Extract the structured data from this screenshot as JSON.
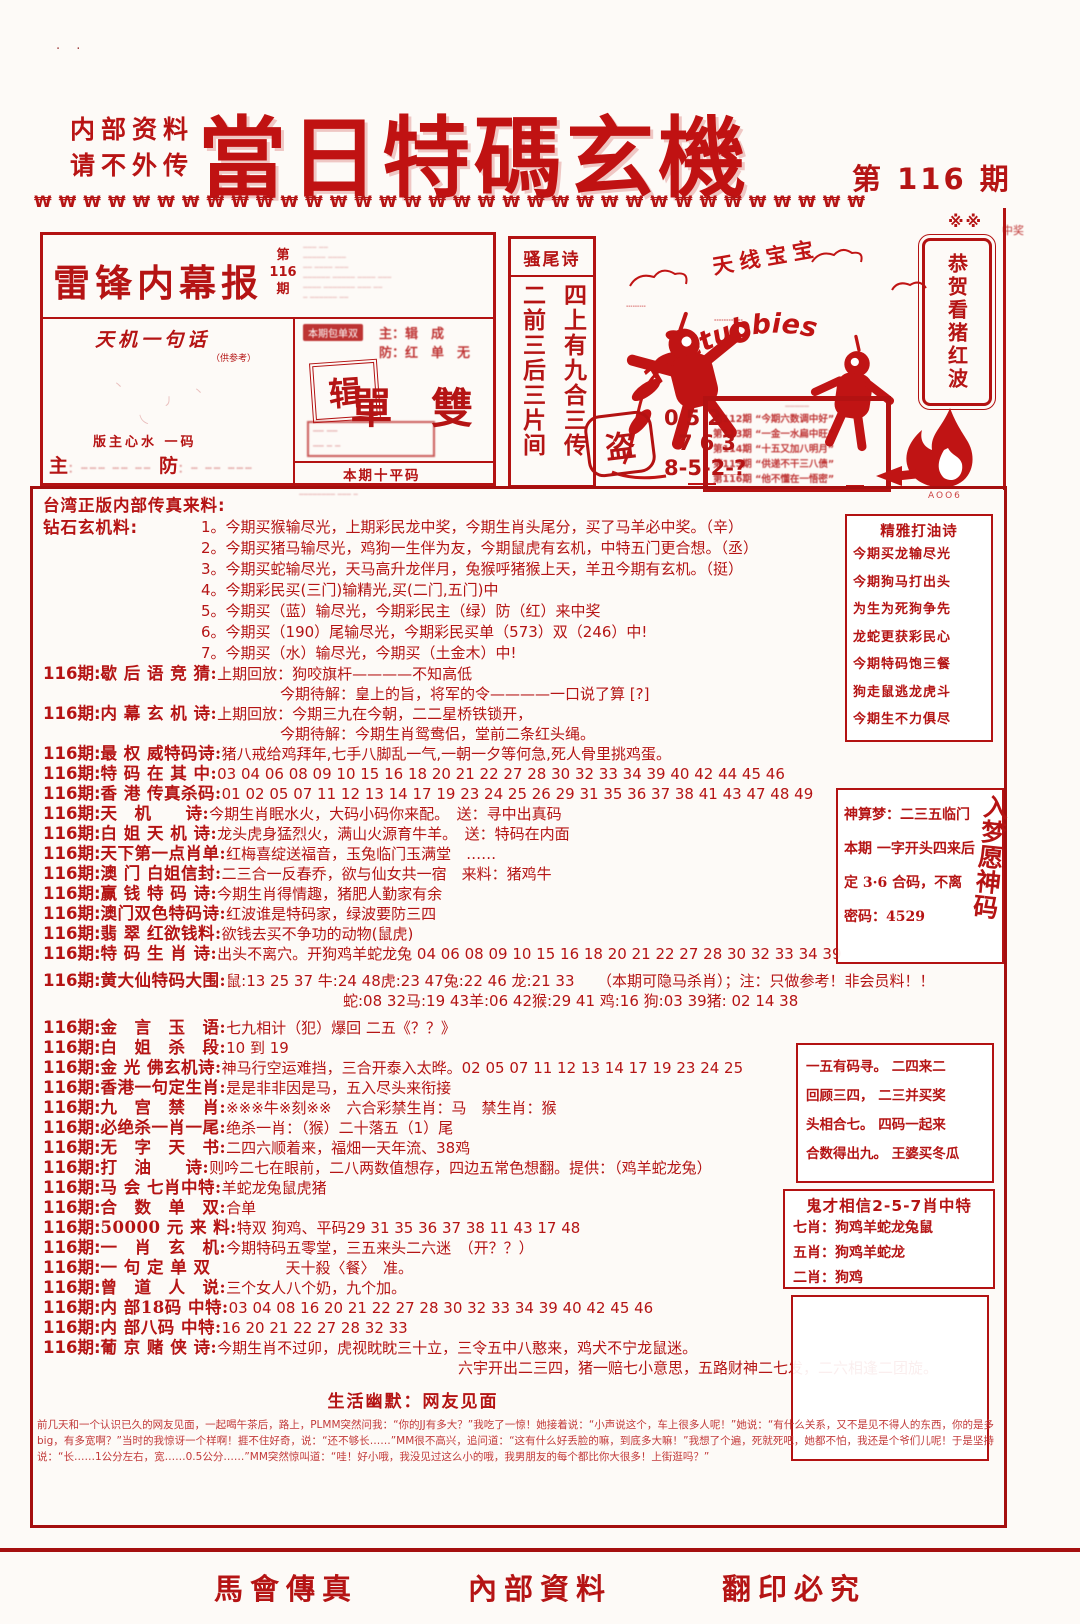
{
  "palette": {
    "red": "#b51414",
    "dark_red": "#a50f0f",
    "bright_red": "#c01212"
  },
  "header": {
    "corner_marks": "· ·",
    "note1": "内部资料",
    "note2": "请不外传",
    "title": "當日特碼玄機",
    "issue": "第 116 期",
    "decor": "₩₩₩₩₩₩₩₩₩₩₩₩₩₩₩₩₩₩₩₩₩₩₩₩₩₩₩₩₩₩₩₩₩₩",
    "decor2": "※※"
  },
  "masthead": {
    "title": "雷锋内幕报",
    "issue_top": "第",
    "issue_mid": "116",
    "issue_bot": "期",
    "small_print": [
      "┄┄┄ ┄┄",
      "┄┄┄┄┄ ┄┄┄┄",
      "┄┄ ┄┄┄┄ ┄┄┄",
      "┄┄┄┄┄┄ ┄┄┄┄┄ ┄┄┄┄ ┄┄┄",
      "┄┄┄┄ ┄┄┄┄┄┄┄ ┄┄┄ ┄┄",
      "┄ ┄┄┄┄┄┄ ┄┄"
    ],
    "tianji_title": "天机一句话",
    "tianji_sub": "（供参考）",
    "tianji_marks": [
      "丶",
      "丿",
      "乀",
      "丶"
    ],
    "banzhu": "版主心水 一码",
    "zhu_label": "主",
    "zhu_blur": "：┄┄┄ ┄┄ ┄┄",
    "fang_label": "防",
    "fang_blur": "：┄ ┄┄ ┄┄┄",
    "right_tag": "本期包单双",
    "zf1": "主：辑　成",
    "zf2": "防：红　单　无",
    "stamp": "辑",
    "dan_shuang": "單 雙",
    "small_box1": "┄┄ ┄┄",
    "small_box2": "┄┄ ┄ ┄",
    "pingma_title": "本期十平码",
    "pingma_l1": "┄┄┄┄ ┄┄┄ ┄┄┄┄┄┄ ┄┄┄┄┄ ┄┄ ┄┄┄┄┄┄┄┄┄",
    "pingma_l2": "┄┄┄┄┄┄┄┄ ┄┄┄ ┄"
  },
  "saoweishi": {
    "title": "骚尾诗",
    "col_right": "四上有九合三传",
    "col_left": "二前三后三片间"
  },
  "tele": {
    "label": "天线宝宝",
    "arc": "Teletubbies",
    "stamp1": "┄┄┄",
    "stamp2": "┄┄┄┄",
    "caption": "┄┄┄┄┄┄"
  },
  "dao_stamp": {
    "char": "盗",
    "n1": "052",
    "n2": "763",
    "n3": "8-5-2-?"
  },
  "recap": {
    "header": "┄┄┄┄┄",
    "lines": [
      "第112期 “今期六数调中好”",
      "第113期 “一金一水扁中旺”",
      "第114期 “十五又加八明月”",
      "第115期 “供递不干三八债”",
      "第116期 “他不懂在一悟密”"
    ]
  },
  "banner": {
    "text": "恭贺看猪红波",
    "note": "中奖"
  },
  "flame": {
    "caption": "AOO6"
  },
  "main": {
    "intro_title": "台湾正版内部传真来料:",
    "intro_label": "钻石玄机料:",
    "intro_items": [
      "1。今期买猴输尽光，上期彩民龙中奖，今期生肖头尾分，买了马羊必中奖。（辛）",
      "2。今期买猪马输尽光，鸡狗一生伴为友，今期鼠虎有玄机，中特五门更合想。（丞）",
      "3。今期买蛇输尽光，天马高升龙伴月，兔猴呼猪猴上天，羊丑今期有玄机。（挺）",
      "4。今期彩民买(三门)输精光,买(二门,五门)中",
      "5。今期买（蓝）输尽光，今期彩民主（绿）防（红）来中奖",
      "6。今期买（190）尾输尽光，今期彩民买单（573）双（246）中!",
      "7。今期买（水）输尽光，今期买（土金木）中!"
    ],
    "rows": [
      {
        "no": "116期:",
        "label": "歇 后 语 竞 猜:",
        "c1": "上期回放：狗咬旗杆————不知高低",
        "c2": "今期待解：皇上的旨，将军的令————一口说了算 [?]"
      },
      {
        "no": "116期:",
        "label": "内 幕 玄 机 诗:",
        "c1": "上期回放：今期三九在今朝，二二星桥铁锁开，",
        "c2": "今期待解：今期生肖鸳鸯侣，堂前二条红头绳。"
      },
      {
        "no": "116期:",
        "label": "最 权 威特码诗:",
        "c1": "猪八戒给鸡拜年,七手八脚乱一气,一朝一夕等何急,死人骨里挑鸡蛋。"
      },
      {
        "no": "116期:",
        "label": "特 码 在 其 中:",
        "c1": "03 04 06 08 09 10 15 16 18 20 21 22 27 28 30 32 33 34 39 40 42 44 45 46"
      },
      {
        "no": "116期:",
        "label": "香 港 传真杀码:",
        "c1": "01 02 05 07 11 12 13 14 17 19 23 24 25 26 29 31 35 36 37 38 41 43 47 48 49"
      },
      {
        "no": "116期:",
        "label": "天　机　　诗:",
        "c1": "今期生肖眠水火，大码小码你来配。　送：寻中出真码"
      },
      {
        "no": "116期:",
        "label": "白 姐 天 机 诗:",
        "c1": "龙头虎身猛烈火，满山火源育牛羊。　送：特码在内面"
      },
      {
        "no": "116期:",
        "label": "天下第一点肖单:",
        "c1": "红梅喜绽送福音，玉兔临门玉满堂　……"
      },
      {
        "no": "116期:",
        "label": "澳 门 白姐信封:",
        "c1": "二三合一反春乔，欲与仙女共一宿　来料：猪鸡牛"
      },
      {
        "no": "116期:",
        "label": "赢 钱 特 码 诗:",
        "c1": "今期生肖得情趣，猪肥人勤家有余"
      },
      {
        "no": "116期:",
        "label": "澳门双色特码诗:",
        "c1": "红波谁是特码家，绿波要防三四"
      },
      {
        "no": "116期:",
        "label": "翡 翠 红欲钱料:",
        "c1": "欲钱去买不争功的动物(鼠虎)"
      },
      {
        "no": "116期:",
        "label": "特 码 生 肖 诗:",
        "c1": "出头不离穴。开狗鸡羊蛇龙兔 04 06 08 09 10 15 16 18 20 21 22 27 28 30 32 33 34 39"
      },
      {
        "no": "116期:",
        "label": "黄大仙特码大围:",
        "c1": "鼠:13 25 37 牛:24 48虎:23 47兔:22 46 龙:21 33　　（本期可隐马杀肖）；注：只做参考！非会员料！！",
        "c2": "蛇:08 32马:19 43羊:06 42猴:29 41 鸡:16 狗:03 39猪: 02 14 38"
      },
      {
        "no": "116期:",
        "label": "金　言　玉　语:",
        "c1": "七九相计（犯）爆回 二五《？？》"
      },
      {
        "no": "116期:",
        "label": "白　姐　杀　段:",
        "c1": "10 到 19"
      },
      {
        "no": "116期:",
        "label": "金 光 佛玄机诗:",
        "c1": "神马行空运难挡，三合开泰入太晔。02 05 07 11 12 13 14 17 19 23 24 25"
      },
      {
        "no": "116期:",
        "label": "香港一句定生肖:",
        "c1": "是是非非因是马，五入尽头来衔接"
      },
      {
        "no": "116期:",
        "label": "九　宫　禁　肖:",
        "c1": "※※※牛※刻※※　六合彩禁生肖：马　禁生肖：猴"
      },
      {
        "no": "116期:",
        "label": "必绝杀一肖一尾:",
        "c1": "绝杀一肖：（猴）二十落五（1）尾"
      },
      {
        "no": "116期:",
        "label": "无　字　天　书:",
        "c1": "二四六顺着来，福畑一天年流、38鸡"
      },
      {
        "no": "116期:",
        "label": "打　油　　诗:",
        "c1": "则吟二七在眼前，二八两数值想存，四边五常色想翻。提供：（鸡羊蛇龙兔）"
      },
      {
        "no": "116期:",
        "label": "马 会 七肖中特:",
        "c1": "羊蛇龙兔鼠虎猪"
      },
      {
        "no": "116期:",
        "label": "合　数　单　双:",
        "c1": "合单"
      },
      {
        "no": "116期:",
        "label": "50000 元 来 料:",
        "c1": "特双 狗鸡、平码29 31 35 36 37 38 11 43 17 48"
      },
      {
        "no": "116期:",
        "label": "一　肖　玄　机:",
        "c1": "今期特码五零堂，三五来头二六迷　（开？？）"
      },
      {
        "no": "116期:",
        "label": "一 句 定 单 双",
        "c1": "　　　　　天十殺〈餐〉　准。"
      },
      {
        "no": "116期:",
        "label": "曾　道　人　说:",
        "c1": "三个女人八个奶，九个加。"
      },
      {
        "no": "116期:",
        "label": "内 部18码 中特:",
        "c1": "03 04 08 16 20 21 22 27 28 30 32 33 34 39 40 42 45 46"
      },
      {
        "no": "116期:",
        "label": "内 部八码 中特:",
        "c1": "16 20 21 22 27 28 32 33"
      },
      {
        "no": "116期:",
        "label": "葡 京 赌 侠 诗:",
        "c1": "今期生肖不过卯，虎视眈眈三十立，三令五中八憨来，鸡犬不宁龙鼠迷。",
        "c2": "六宇开出二三四，猪一赔七小意思，五路财神二七发，二六相逢二团旋。"
      }
    ],
    "humor_title": "生活幽默：网友见面",
    "humor_text": "前几天和一个认识已久的网友见面，一起喝午茶后，路上，PLMM突然问我：“你的JJ有多大？”我吃了一惊！她接着说：“小声说这个，车上很多人呢！”她说：“有什么关系，又不是见不得人的东西，你的是多big，有多宽啊？”当时的我惊讶一个样啊！捱不住好奇，说：“还不够长……”MM很不高兴，追问道：“这有什么好丢脸的嘛，到底多大嘛！”我想了个遍，死就死吧，她都不怕，我还是个爷们儿呢！于是坚持说：“长……1公分左右，宽……0.5公分……”MM突然惊叫道：“哇！好小哦，我没见过这么小的哦，我男朋友的每个都比你大很多！上街逛吗？”",
    "boxes": {
      "dayou": {
        "title": "精雅打油诗",
        "lines": [
          "今期买龙输尽光",
          "今期狗马打出头",
          "为生为死狗争先",
          "龙蛇更获彩民心",
          "今期特码饱三餐",
          "狗走鼠逃龙虎斗",
          "今期生不力俱尽"
        ]
      },
      "shensuan": {
        "l1": "神算梦：二三五临门",
        "l2": "本期 一字开头四来后",
        "l3": "定 3·6 合码，不离",
        "l4": "密码：4529",
        "vert": "入梦愿神码"
      },
      "mystery": {
        "lines": [
          "一五有码寻。 二四来二",
          "回顾三四， 二三并买奖",
          "头相合七。 四码一起来",
          "合数得出九。 王婆买冬瓜"
        ]
      },
      "guicai": {
        "title": "鬼才相信2-5-7肖中特",
        "lines": [
          "七肖：狗鸡羊蛇龙兔鼠",
          "五肖：狗鸡羊蛇龙",
          "二肖：狗鸡"
        ]
      }
    }
  },
  "footer": {
    "f1": "馬會傳真",
    "f2": "內部資料",
    "f3": "翻印必究"
  }
}
